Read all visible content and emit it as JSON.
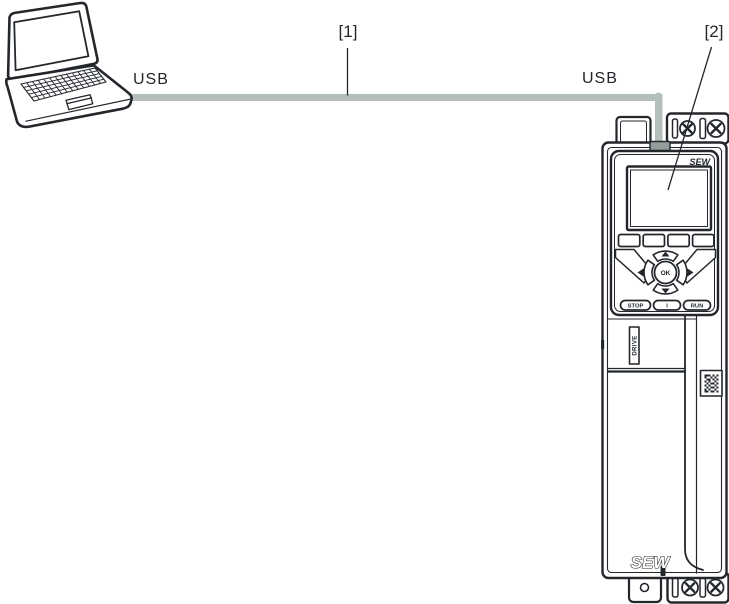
{
  "figure": {
    "type": "connection-diagram",
    "callouts": {
      "item1": "[1]",
      "item2": "[2]"
    },
    "connection_labels": {
      "left": "USB",
      "right": "USB"
    }
  },
  "device": {
    "keypad": {
      "brand": "SEW",
      "ok": "OK",
      "stop": "STOP",
      "middle": "I",
      "run": "RUN"
    },
    "side_label": "DRIVE",
    "bottom_brand": "SEW"
  },
  "icons": {
    "laptop": "laptop-computer",
    "cable": "usb-cable",
    "screw": "phillips-screw",
    "qr": "data-matrix-code",
    "arrows": [
      "up-arrow",
      "down-arrow",
      "left-arrow",
      "right-arrow"
    ]
  },
  "colors": {
    "line": "#23272c",
    "cable": "#b4beba",
    "connector": "#939d9a",
    "background": "#ffffff"
  }
}
